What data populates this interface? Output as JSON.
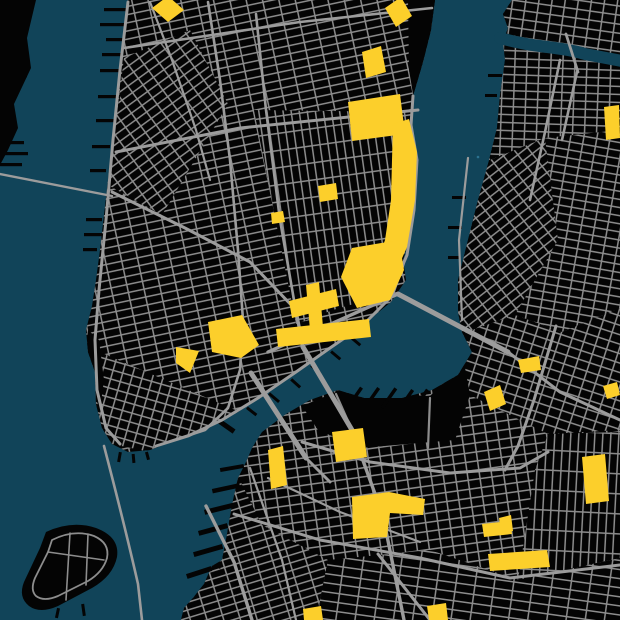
{
  "app": {
    "type": "map-visualization",
    "description": "Dark poster-style street map of Lower Manhattan, the East River and northwest Brooklyn; land is black, streets are gray, water is deep teal, parks and plazas are highlighted yellow",
    "visible_text": "none"
  },
  "theme": {
    "water": "#114459",
    "land": "#040404",
    "road": "#8d8d8d",
    "road_major": "#9c9c9c",
    "park": "#fccf2b",
    "speck": "#2b7290"
  },
  "features": {
    "water_bodies": [
      "hudson-river",
      "east-river",
      "newtown-creek",
      "wallabout-bay",
      "upper-bay",
      "buttermilk-channel"
    ],
    "land_masses": [
      "jersey-shore-sliver",
      "manhattan",
      "brooklyn-queens",
      "governors-island"
    ],
    "bridges": [
      "brooklyn-bridge",
      "manhattan-bridge",
      "williamsburg-bridge",
      "pulaski-bridge"
    ],
    "tunnels": [
      "holland-tunnel",
      "brooklyn-battery-tunnel"
    ],
    "parks_highlighted": [
      "washington-square",
      "stuyvesant-square",
      "union-square-east",
      "tompkins-square",
      "east-river-park-north",
      "east-river-park-south",
      "first-park",
      "little-park",
      "sara-d-roosevelt-park",
      "seward-park",
      "east-broadway-strip",
      "columbus-park",
      "city-hall-park",
      "williamsburg-triangle",
      "south-williamsburg-diamond",
      "bushwick-small-park",
      "cooper-park-edge",
      "commodore-barry-park",
      "cadman-plaza",
      "fort-greene-park",
      "pratt-field",
      "clinton-hill-small",
      "atlantic-bar",
      "fulton-small",
      "bottom-park-west",
      "bottom-park-east"
    ],
    "street_grids": [
      "west-village",
      "gridiron",
      "lower-east-side",
      "soho-tribeca",
      "financial-district",
      "long-island-city",
      "greenpoint",
      "williamsburg-west",
      "williamsburg-east",
      "south-williamsburg",
      "downtown-brooklyn",
      "clinton-hill",
      "carroll-gardens",
      "park-slope",
      "red-hook"
    ]
  }
}
